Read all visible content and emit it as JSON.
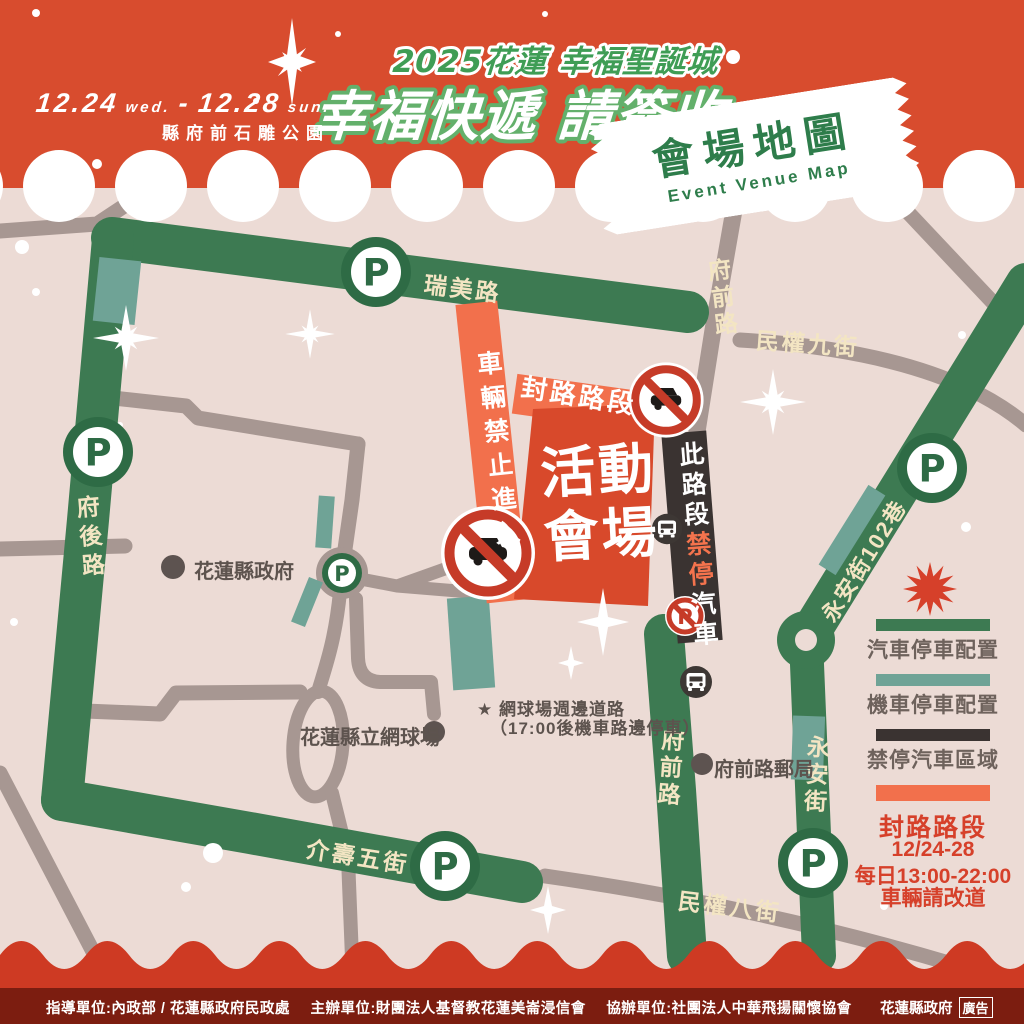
{
  "header": {
    "date": {
      "start": "12.24",
      "start_day": "wed.",
      "sep": "-",
      "end": "12.28",
      "end_day": "sun."
    },
    "location": "縣府前石雕公園",
    "event_title": "2025花蓮 幸福聖誕城",
    "main_slogan": "幸福快遞 請簽收",
    "ticket": {
      "title": "會場地圖",
      "subtitle": "Event Venue Map"
    }
  },
  "map": {
    "parking_letter": "P",
    "roads": {
      "ruimei": "瑞美路",
      "fuqian_north": "府前路",
      "minquan9": "民權九街",
      "fuhou": "府後路",
      "yongan102": "永安街102巷",
      "jieshou5": "介壽五街",
      "fuqian_south": "府前路",
      "yongan": "永安街",
      "minquan8": "民權八街"
    },
    "venue": {
      "line1": "活動",
      "line2": "會場"
    },
    "closed_road_label": "封路路段",
    "no_entry_label": "車輛禁止進入",
    "no_parking_zone": {
      "part1": "此路段",
      "part2": "禁停",
      "part3": "汽車"
    },
    "pois": [
      {
        "name": "花蓮縣政府"
      },
      {
        "name": "花蓮縣立網球場"
      },
      {
        "name": "府前路郵局"
      }
    ],
    "note_line1": "★ 網球場週邊道路",
    "note_line2": "（17:00後機車路邊停車）"
  },
  "legend": {
    "car_parking": "汽車停車配置",
    "moto_parking": "機車停車配置",
    "no_parking": "禁停汽車區域",
    "closure_title": "封路路段",
    "closure_dates": "12/24-28",
    "closure_time": "每日13:00-22:00",
    "closure_note": "車輛請改道"
  },
  "footer": {
    "credit1": "指導單位:內政部 / 花蓮縣政府民政處",
    "credit2": "主辦單位:財團法人基督教花蓮美崙浸信會",
    "credit3": "協辦單位:社團法人中華飛揚關懷協會",
    "org": "花蓮縣政府",
    "ad": "廣告"
  },
  "colors": {
    "header_bg": "#d84c2e",
    "map_bg": "#ecdbd5",
    "wave_red": "#ce3a23",
    "footer_bg": "#7c1d10",
    "road_car_parking": "#3d7a52",
    "road_moto_parking": "#6fa396",
    "road_no_parking": "#3a3331",
    "road_closed": "#f2704c",
    "road_default": "#a79792",
    "venue_red": "#d8492b",
    "road_label_cream": "#f3e5c3",
    "accent_red": "#d6402a",
    "title_green": "#3f9d55",
    "ticket_green": "#2e7d4b",
    "sign_red": "#c63b28"
  }
}
